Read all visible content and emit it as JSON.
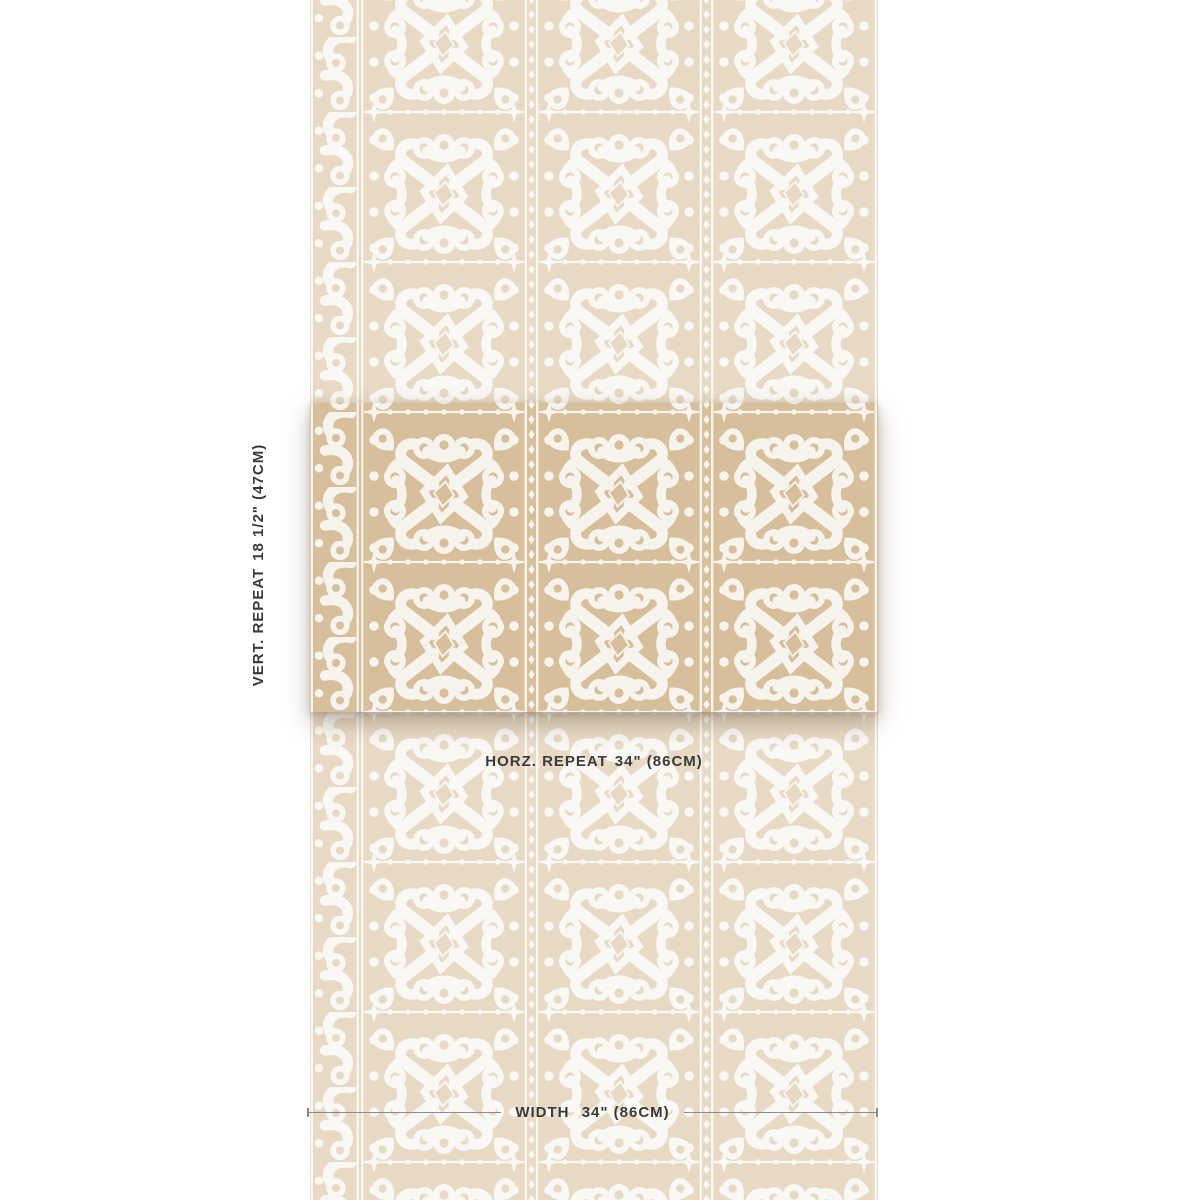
{
  "page": {
    "background": "#ffffff"
  },
  "theme": {
    "ground": "#d8bf9b",
    "motif": "#f7f4ee",
    "faded-opacity": "0.57",
    "text-color": "#3a3a3a",
    "line-color": "#8b8b8b"
  },
  "swatch": {
    "description": "folk medallion wallpaper swatch",
    "pattern_elements": [
      "scroll-wave-border",
      "loop-medallion",
      "diamond-center",
      "teardrop-corners",
      "diamond-chain-divider",
      "four-point-stars",
      "dot-columns"
    ]
  },
  "annotations": {
    "vertical_repeat": {
      "label": "VERT. REPEAT",
      "value": "18 1/2\" (47CM)"
    },
    "horizontal_repeat": {
      "label": "HORZ. REPEAT",
      "value": "34\" (86CM)"
    },
    "width": {
      "label": "WIDTH",
      "value": "34\" (86CM)"
    }
  }
}
